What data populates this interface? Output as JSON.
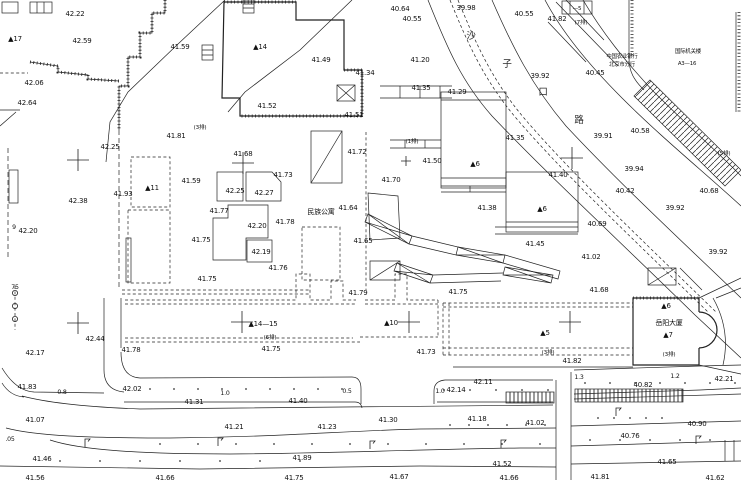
{
  "plan": {
    "bg": "#ffffff",
    "ink": "#1a1a1a",
    "labels": {
      "elevations": [
        [
          "42.22",
          75,
          16
        ],
        [
          "42.59",
          82,
          43
        ],
        [
          "41.59",
          180,
          49
        ],
        [
          "42.06",
          34,
          85
        ],
        [
          "42.64",
          27,
          105
        ],
        [
          "40.64",
          400,
          11
        ],
        [
          "40.55",
          412,
          21
        ],
        [
          "39.98",
          466,
          10
        ],
        [
          "40.55",
          524,
          16
        ],
        [
          "41.82",
          557,
          21
        ],
        [
          "41.34",
          365,
          75
        ],
        [
          "41.49",
          321,
          62
        ],
        [
          "41.52",
          267,
          108
        ],
        [
          "41.51",
          354,
          117
        ],
        [
          "41.20",
          420,
          62
        ],
        [
          "41.35",
          421,
          90
        ],
        [
          "41.29",
          457,
          94
        ],
        [
          "39.92",
          540,
          78
        ],
        [
          "40.45",
          595,
          75
        ],
        [
          "41.81",
          176,
          138
        ],
        [
          "42.25",
          110,
          149
        ],
        [
          "42.38",
          78,
          203
        ],
        [
          "41.93",
          123,
          196
        ],
        [
          "42.20",
          28,
          233
        ],
        [
          "41.68",
          243,
          156
        ],
        [
          "41.73",
          283,
          177
        ],
        [
          "42.25",
          235,
          193
        ],
        [
          "42.27",
          264,
          195
        ],
        [
          "41.59",
          191,
          183
        ],
        [
          "41.77",
          219,
          213
        ],
        [
          "42.20",
          257,
          228
        ],
        [
          "41.78",
          285,
          224
        ],
        [
          "41.75",
          201,
          242
        ],
        [
          "42.19",
          261,
          254
        ],
        [
          "41.76",
          278,
          270
        ],
        [
          "41.75",
          207,
          281
        ],
        [
          "41.72",
          357,
          154
        ],
        [
          "41.70",
          391,
          182
        ],
        [
          "41.64",
          348,
          210
        ],
        [
          "41.65",
          363,
          243
        ],
        [
          "41.50",
          432,
          163
        ],
        [
          "41.35",
          515,
          140
        ],
        [
          "41.40",
          558,
          177
        ],
        [
          "41.38",
          487,
          210
        ],
        [
          "41.45",
          535,
          246
        ],
        [
          "40.58",
          640,
          133
        ],
        [
          "39.91",
          603,
          138
        ],
        [
          "39.94",
          634,
          171
        ],
        [
          "40.42",
          625,
          193
        ],
        [
          "40.68",
          709,
          193
        ],
        [
          "39.92",
          675,
          210
        ],
        [
          "40.69",
          597,
          226
        ],
        [
          "39.92",
          718,
          254
        ],
        [
          "41.02",
          591,
          259
        ],
        [
          "41.68",
          599,
          292
        ],
        [
          "42.17",
          35,
          355
        ],
        [
          "42.44",
          95,
          341
        ],
        [
          "41.78",
          131,
          352
        ],
        [
          "41.83",
          27,
          389
        ],
        [
          "42.02",
          132,
          391
        ],
        [
          "41.79",
          358,
          295
        ],
        [
          "41.75",
          271,
          351
        ],
        [
          "41.75",
          458,
          294
        ],
        [
          "41.73",
          426,
          354
        ],
        [
          "41.82",
          572,
          363
        ],
        [
          "42.11",
          483,
          384
        ],
        [
          "42.14",
          456,
          392
        ],
        [
          "42.21",
          724,
          381
        ],
        [
          "40.82",
          643,
          387
        ],
        [
          "41.31",
          194,
          404
        ],
        [
          "41.40",
          298,
          403
        ],
        [
          "41.07",
          35,
          422
        ],
        [
          "41.21",
          234,
          429
        ],
        [
          "41.23",
          327,
          429
        ],
        [
          "41.30",
          388,
          422
        ],
        [
          "41.18",
          477,
          421
        ],
        [
          "41.02",
          535,
          425
        ],
        [
          "40.90",
          697,
          426
        ],
        [
          "40.76",
          630,
          438
        ],
        [
          "41.46",
          42,
          461
        ],
        [
          "41.89",
          302,
          460
        ],
        [
          "41.52",
          502,
          466
        ],
        [
          "41.65",
          667,
          464
        ],
        [
          "41.56",
          35,
          480
        ],
        [
          "41.66",
          165,
          480
        ],
        [
          "41.75",
          294,
          480
        ],
        [
          "41.67",
          399,
          479
        ],
        [
          "41.66",
          509,
          480
        ],
        [
          "41.81",
          600,
          479
        ],
        [
          "41.62",
          715,
          480
        ]
      ],
      "buildings": [
        [
          "▲17",
          15,
          41
        ],
        [
          "▲14",
          260,
          49
        ],
        [
          "▲11",
          152,
          190
        ],
        [
          "▲6",
          475,
          166
        ],
        [
          "▲6",
          542,
          211
        ],
        [
          "▲14—15",
          263,
          326
        ],
        [
          "▲10",
          391,
          325
        ],
        [
          "▲5",
          545,
          335
        ],
        [
          "▲6",
          666,
          308
        ],
        [
          "▲7",
          668,
          337
        ]
      ],
      "notes": [
        [
          "(3排)",
          200,
          129
        ],
        [
          "(1排)",
          412,
          143
        ],
        [
          "(5排)",
          724,
          155
        ],
        [
          "(6排)",
          270,
          339
        ],
        [
          "(3排)",
          548,
          354
        ],
        [
          "(3排)",
          669,
          356
        ],
        [
          "(7排)",
          581,
          24
        ],
        [
          "—5",
          577,
          10
        ]
      ],
      "chinese": [
        [
          "民族公寓",
          321,
          214
        ],
        [
          "岳阳大厦",
          669,
          325
        ]
      ],
      "chinese_small": [
        [
          "中国农业银行",
          622,
          58
        ],
        [
          "北京市分行",
          622,
          66
        ],
        [
          "国际机关楼",
          688,
          53
        ],
        [
          "A3—16",
          687,
          65
        ]
      ],
      "street_chars": [
        [
          "沙",
          471,
          39
        ],
        [
          "子",
          507,
          67
        ],
        [
          "口",
          543,
          95
        ],
        [
          "路",
          579,
          123
        ]
      ],
      "dims": [
        [
          "0.8",
          62,
          394
        ],
        [
          "1.0",
          225,
          395
        ],
        [
          "0.5",
          347,
          393
        ],
        [
          "1.0",
          440,
          393
        ],
        [
          "1.3",
          579,
          379
        ],
        [
          "1.2",
          675,
          378
        ],
        [
          ".05",
          10,
          441
        ],
        [
          "75",
          15,
          289
        ],
        [
          "9",
          14,
          229
        ]
      ]
    },
    "symbols": {
      "crosses": [
        [
          78,
          160
        ],
        [
          243,
          163
        ],
        [
          572,
          158
        ],
        [
          78,
          323
        ],
        [
          242,
          322
        ],
        [
          409,
          322
        ],
        [
          570,
          322
        ]
      ],
      "crosses_small": [
        [
          406,
          161
        ]
      ],
      "lamps": [
        [
          85,
          447
        ],
        [
          218,
          446
        ],
        [
          370,
          449
        ],
        [
          501,
          448
        ],
        [
          696,
          444
        ],
        [
          616,
          416
        ]
      ],
      "tree_circles": [
        [
          15,
          293
        ],
        [
          15,
          306
        ],
        [
          15,
          319
        ]
      ],
      "dot_rows": [
        {
          "y": 389,
          "x0": 150,
          "x1": 342,
          "step": 24
        },
        {
          "y": 390,
          "x0": 444,
          "x1": 548,
          "step": 26
        },
        {
          "y": 383,
          "x0": 585,
          "x1": 735,
          "step": 25
        },
        {
          "y": 425,
          "x0": 450,
          "x1": 545,
          "step": 19
        },
        {
          "y": 418,
          "x0": 598,
          "x1": 662,
          "step": 16
        },
        {
          "y": 444,
          "x0": 160,
          "x1": 540,
          "step": 38
        },
        {
          "y": 440,
          "x0": 590,
          "x1": 730,
          "step": 30
        },
        {
          "y": 461,
          "x0": 60,
          "x1": 300,
          "step": 40
        }
      ]
    }
  }
}
